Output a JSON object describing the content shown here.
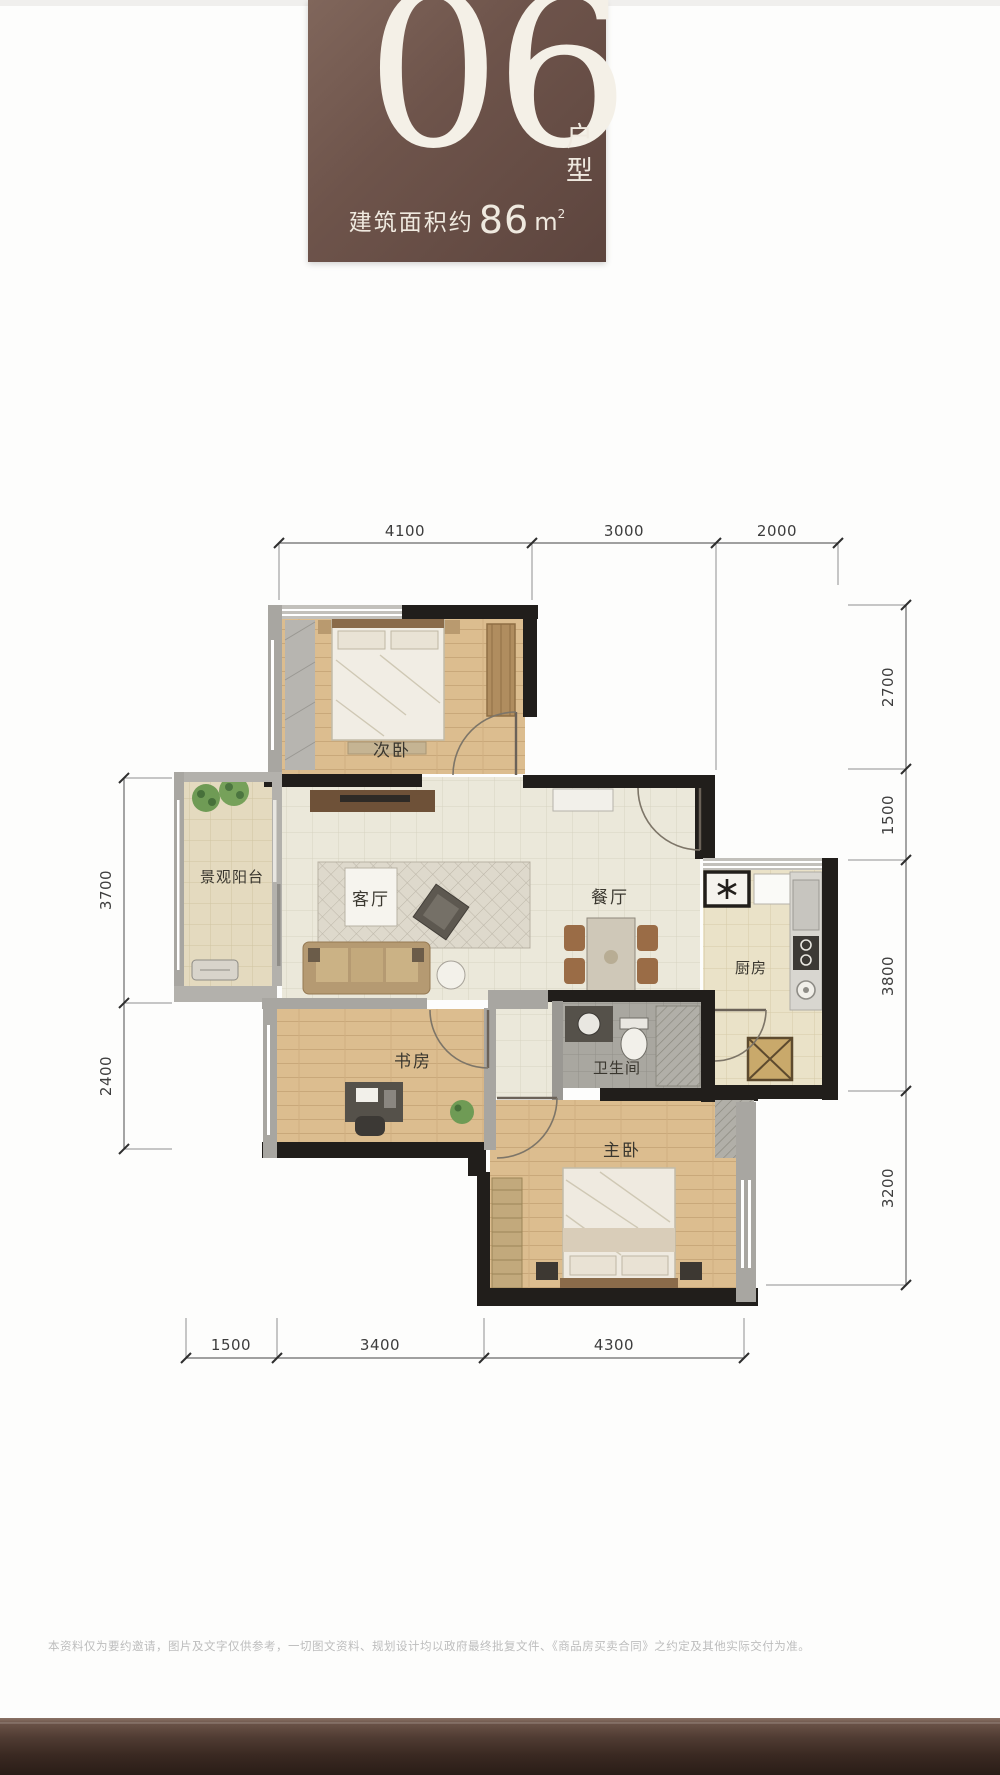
{
  "header": {
    "number": "06",
    "type_vertical": "户型",
    "area_label": "建筑面积约",
    "area_value": "86",
    "area_unit": "m",
    "area_exponent": "2"
  },
  "rooms": {
    "bedroom2": "次卧",
    "balcony": "景观阳台",
    "living": "客厅",
    "dining": "餐厅",
    "kitchen": "厨房",
    "bathroom": "卫生间",
    "study": "书房",
    "master": "主卧"
  },
  "dims": {
    "top": [
      "4100",
      "3000",
      "2000"
    ],
    "right": [
      "2700",
      "1500",
      "3800",
      "3200"
    ],
    "left": [
      "3700",
      "2400"
    ],
    "bottom": [
      "1500",
      "3400",
      "4300"
    ]
  },
  "icons": {
    "fridge": "snowflake-star",
    "basket": "crossed-storage-box"
  },
  "colors": {
    "header_bg": "#6e544b",
    "header_text": "#f2ede4",
    "wall_black": "#211e1b",
    "wall_gray": "#a8a6a1",
    "wood_floor": "#dcbd8f",
    "tile_floor": "#ebe8da"
  },
  "footer": {
    "disclaimer": "本资料仅为要约邀请，图片及文字仅供参考，一切图文资料、规划设计均以政府最终批复文件、《商品房买卖合同》之约定及其他实际交付为准。"
  }
}
